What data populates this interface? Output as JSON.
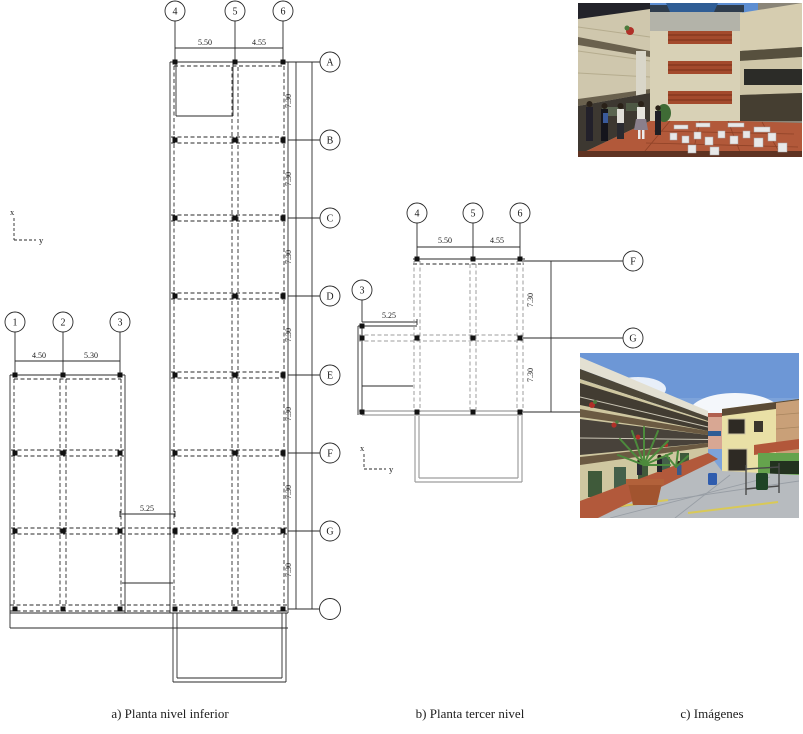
{
  "figure": {
    "captions": [
      {
        "id": "a",
        "text": "a) Planta nivel inferior"
      },
      {
        "id": "b",
        "text": "b) Planta tercer nivel"
      },
      {
        "id": "c",
        "text": "c) Imágenes"
      }
    ]
  },
  "plan_a": {
    "name": "Planta nivel inferior",
    "cols": {
      "c1": "1",
      "c2": "2",
      "c3": "3",
      "c4": "4",
      "c5": "5",
      "c6": "6"
    },
    "rows": {
      "A": "A",
      "B": "B",
      "C": "C",
      "D": "D",
      "E": "E",
      "F": "F",
      "G": "G",
      "O": ""
    },
    "dims": {
      "d45": "5.50",
      "d56": "4.55",
      "d12": "4.50",
      "d23": "5.30",
      "d34": "5.25",
      "row": "7.30"
    },
    "axis": {
      "x": "x",
      "y": "y"
    }
  },
  "plan_b": {
    "name": "Planta tercer nivel",
    "cols": {
      "c3": "3",
      "c4": "4",
      "c5": "5",
      "c6": "6"
    },
    "rows": {
      "F": "F",
      "G": "G",
      "O": ""
    },
    "dims": {
      "d45": "5.50",
      "d56": "4.55",
      "d34": "5.25",
      "row": "7.30"
    },
    "axis": {
      "x": "x",
      "y": "y"
    }
  },
  "colors": {
    "line": "#2a2a2a",
    "gray_line": "#9e9e9e",
    "terracotta": "#b2593a",
    "sky": "#7da3da",
    "cream_wall": "#cfc7a0",
    "brick": "#a34a2c"
  }
}
